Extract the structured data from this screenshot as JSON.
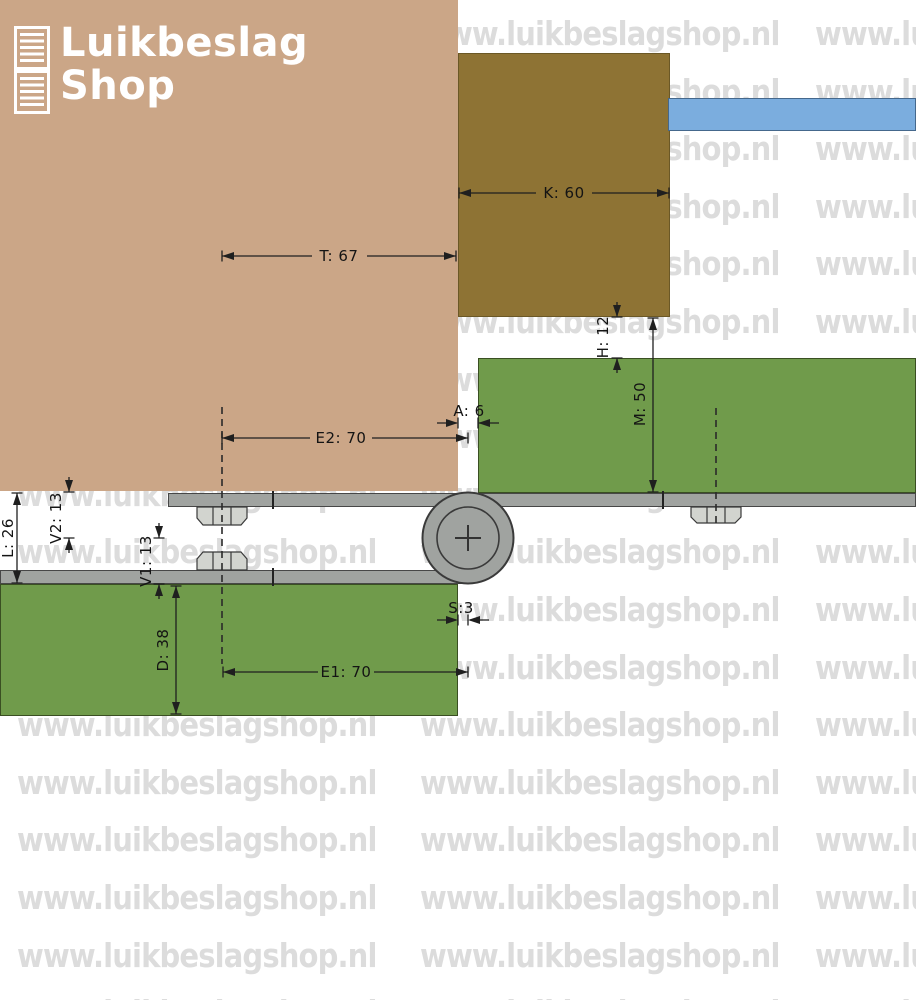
{
  "logo": {
    "line1": "Luikbeslag",
    "line2": "Shop"
  },
  "watermark": {
    "text": "www.luikbeslagshop.nl"
  },
  "dimensions": {
    "K": "K: 60",
    "T": "T: 67",
    "H": "H: 12",
    "M": "M: 50",
    "A": "A: 6",
    "E2": "E2: 70",
    "V2": "V2: 13",
    "L": "L: 26",
    "V1": "V1: 13",
    "S": "S:3",
    "D": "D: 38",
    "E1": "E1: 70"
  },
  "colors": {
    "shutter_tan": "#cba687",
    "frame_brown": "#8e7334",
    "wall_blue": "#7badde",
    "frame_green": "#709b4b",
    "steel_gray": "#a0a3a0",
    "nut_gray": "#d2d4cf",
    "watermark_gray": "#dcdcdc",
    "dimension_line": "#1f1f1f",
    "logo_white": "#ffffff"
  }
}
